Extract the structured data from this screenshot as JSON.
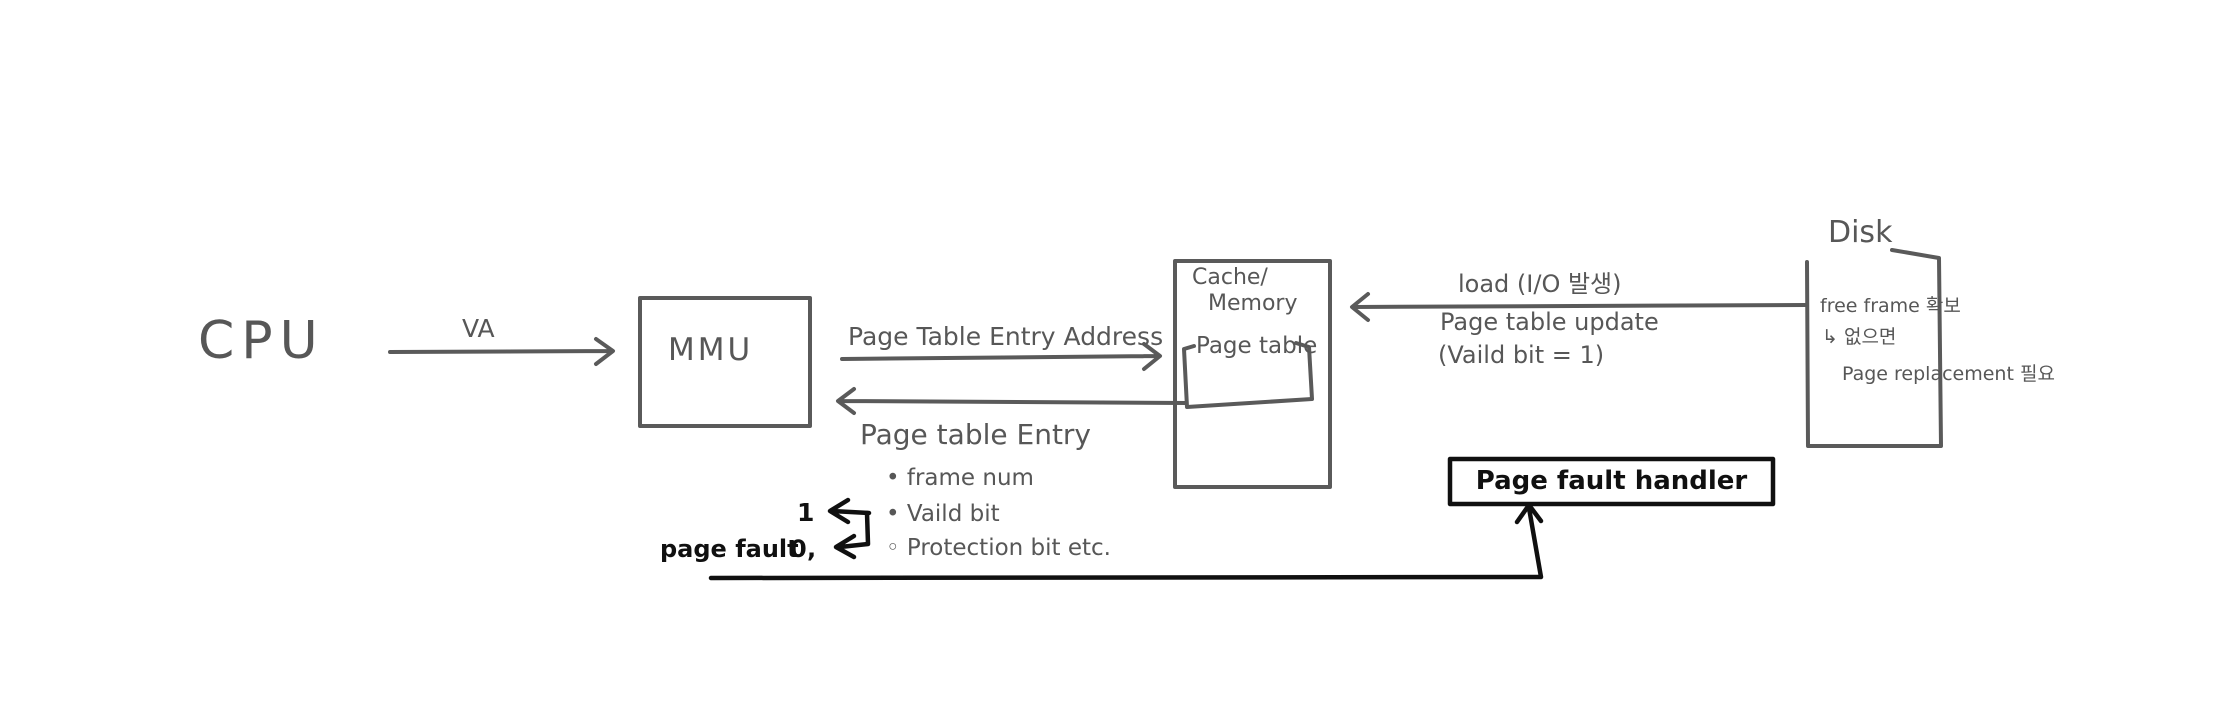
{
  "colors": {
    "background": "#ffffff",
    "ink_gray": "#5a5a5a",
    "ink_black": "#101010"
  },
  "nodes": {
    "cpu": {
      "label": "CPU"
    },
    "mmu": {
      "label": "MMU"
    },
    "cache": {
      "title_line1": "Cache/",
      "title_line2": "Memory",
      "page_table_label": "Page table"
    },
    "page_fault_handler": {
      "label": "Page fault handler"
    },
    "disk": {
      "label": "Disk",
      "note1": "free frame 확보",
      "note2": "↳ 없으면",
      "note3": "Page replacement 필요"
    }
  },
  "arrows": {
    "va": {
      "label": "VA"
    },
    "pte_address": {
      "label": "Page Table Entry Address"
    },
    "pte_return": {
      "label": "Page table Entry"
    },
    "load": {
      "line1": "load (I/O 발생)",
      "line2": "Page table update",
      "line3": "(Vaild bit = 1)"
    }
  },
  "pte_fields": {
    "items": [
      "• frame num",
      "• Vaild bit",
      "◦ Protection bit  etc."
    ]
  },
  "valid_bit": {
    "one": "1",
    "zero": "0",
    "page_fault_label": "page fault ,"
  }
}
